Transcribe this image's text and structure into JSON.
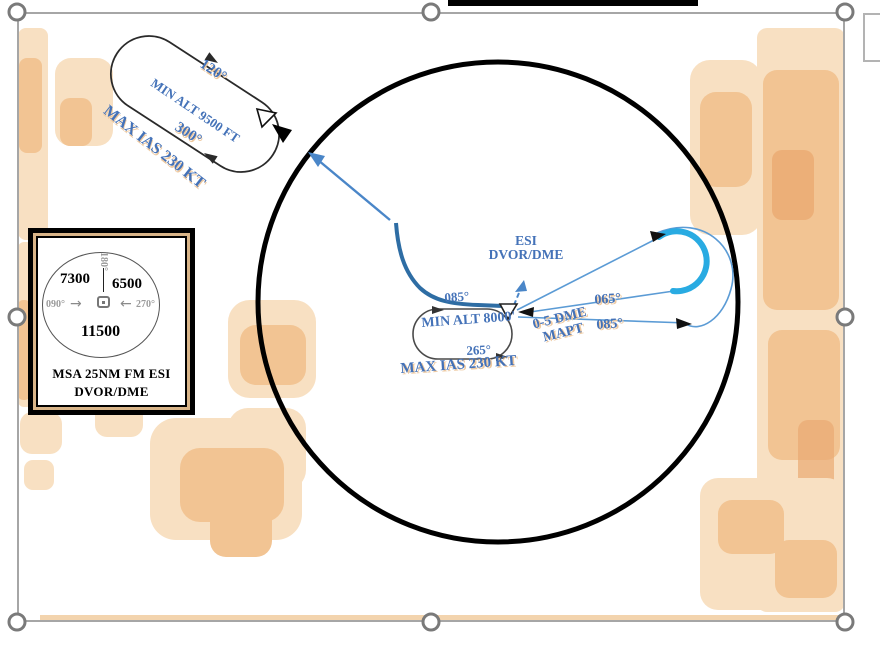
{
  "hold_nw": {
    "outbound": "120°",
    "min_alt": "MIN ALT 9500 FT",
    "inbound": "300°",
    "max_ias": "MAX IAS 230 KT"
  },
  "msa": {
    "sector_nw": "7300",
    "sector_ne": "6500",
    "sector_s": "11500",
    "bearing_top": "180°",
    "bearing_left": "090°",
    "bearing_right": "270°",
    "arrow_to_center_right": "→",
    "arrow_to_center_left": "←",
    "caption_line1": "MSA 25NM FM ESI",
    "caption_line2": "DVOR/DME"
  },
  "fix": {
    "line1": "ESI",
    "line2": "DVOR/DME"
  },
  "hold_center": {
    "inbound": "085°",
    "min_alt": "MIN ALT 8000'",
    "outbound": "265°",
    "max_ias": "MAX IAS 230 KT"
  },
  "mapt": {
    "line1": "0-5 DME",
    "line2": "MAPT"
  },
  "teardrop": {
    "outbound": "065°",
    "inbound": "085°"
  },
  "colors": {
    "blue_text": "#4472b8",
    "cyan_turn": "#29abe2",
    "thin_blue": "#5b9bd5",
    "approach_blue": "#2e6da4",
    "terrain_light": "#f8e0c2",
    "terrain_mid": "#f2c493",
    "terrain_dark": "#eaaa72",
    "handle_gray": "#7a7a7a"
  }
}
